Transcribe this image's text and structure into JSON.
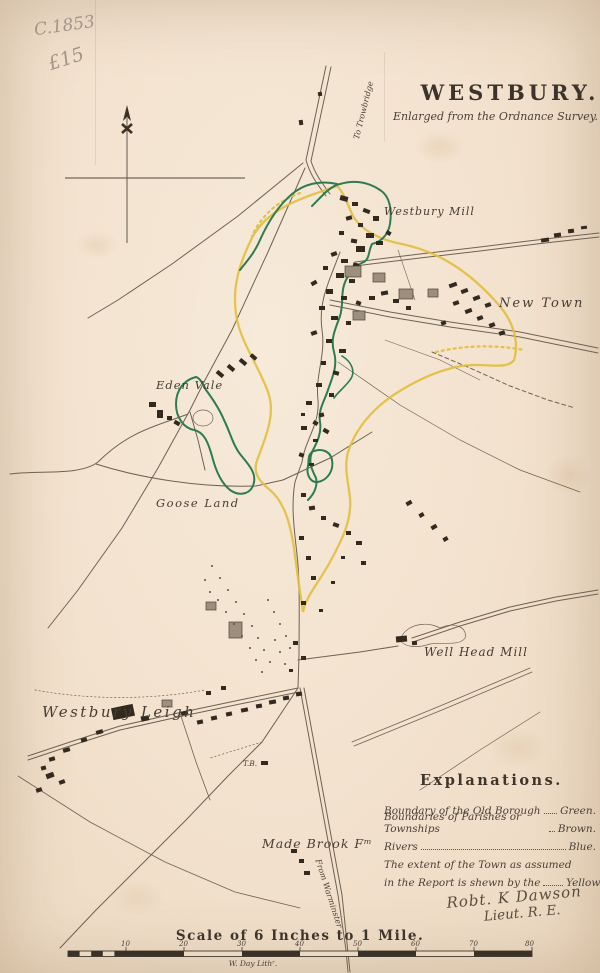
{
  "annotations": {
    "pencil_date": "C.1853",
    "pencil_price": "£15"
  },
  "header": {
    "title": "WESTBURY.",
    "subtitle": "Enlarged from the Ordnance Survey."
  },
  "map_labels": {
    "to_trowbridge": "To Trowbridge",
    "westbury_mill": "Westbury Mill",
    "new_town": "New Town",
    "eden_vale": "Eden Vale",
    "goose_land": "Goose Land",
    "well_head_mill": "Well Head Mill",
    "westbury_leigh": "Westbury Leigh",
    "turnpike_bar": "T.B.",
    "made_brook_farm": "Made Brook Fᵐ",
    "from_warminster": "From Warminster"
  },
  "legend": {
    "heading": "Explanations.",
    "rows": [
      {
        "label": "Boundary of the Old Borough",
        "value": "Green."
      },
      {
        "label": "Boundaries of Parishes or Townships",
        "value": "Brown."
      },
      {
        "label": "Rivers",
        "value": "Blue."
      },
      {
        "label": "The extent of the Town as assumed",
        "value": ""
      },
      {
        "label": "in the Report is shewn by the",
        "value": "Yellow Li"
      }
    ]
  },
  "signature": {
    "line1": "Robt. K Dawson",
    "line2": "Lieut. R. E."
  },
  "scale": {
    "caption": "Scale of 6 Inches to 1 Mile.",
    "ticks": [
      "10",
      "20",
      "30",
      "40",
      "50",
      "60",
      "70",
      "80"
    ],
    "credit": "W. Day Lithʳ."
  },
  "colors": {
    "old_borough_green": "#2e7b52",
    "town_extent_yellow": "#e2bd3c",
    "ink": "#4a4038",
    "paper": "#f2e1ce"
  }
}
